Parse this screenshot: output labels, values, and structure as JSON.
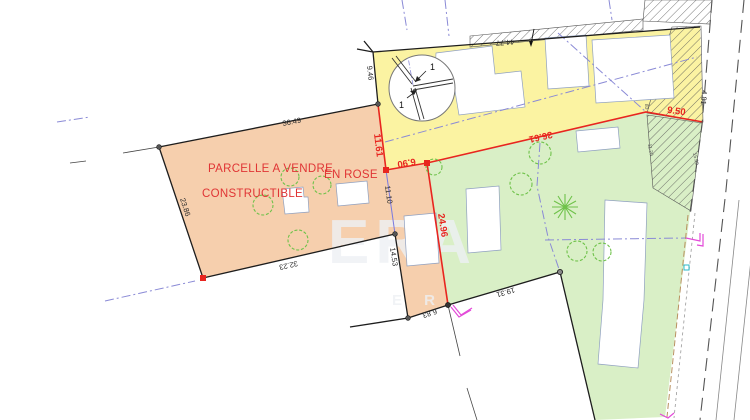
{
  "plan": {
    "labels": {
      "sale_line1": "PARCELLE A VENDRE",
      "sale_line2": "EN ROSE",
      "sale_line3": "CONSTRUCTIBLE"
    },
    "watermark": {
      "line1": "ERA",
      "line2": "E R"
    },
    "detail_bubble": {
      "ref_a": "1",
      "ref_b": "1"
    },
    "dims": {
      "orange_top": "36.49",
      "orange_left": "23.86",
      "orange_bottom": "32.23",
      "orange_right_upper_red": "11.61",
      "orange_right_mid": "11.10",
      "orange_right_lower": "14.53",
      "corridor_top_red": "6.90",
      "corridor_right_red": "24.96",
      "corridor_bottom": "6.83",
      "yellow_left": "9.46",
      "yellow_top": "44.77",
      "boundary_mid_red": "36.61",
      "boundary_right_red": "9.50",
      "road_right": "4.81",
      "green_bottom": "19.31",
      "hatch_small_left": "11.20",
      "hatch_small_right": "15.09",
      "hatch_small_top": "83"
    },
    "colors": {
      "parcel_orange": "#f6cfad",
      "parcel_yellow": "#fbf3a2",
      "parcel_green": "#d9efc6",
      "boundary_red": "#e8251f",
      "label_red": "#e03535",
      "tree_green": "#6fc24a",
      "gate_magenta": "#e34ad8",
      "guide_blue": "#8a8ad6",
      "cyan_marker": "#2bb8c8",
      "watermark_gray": "#eef1f5"
    }
  }
}
